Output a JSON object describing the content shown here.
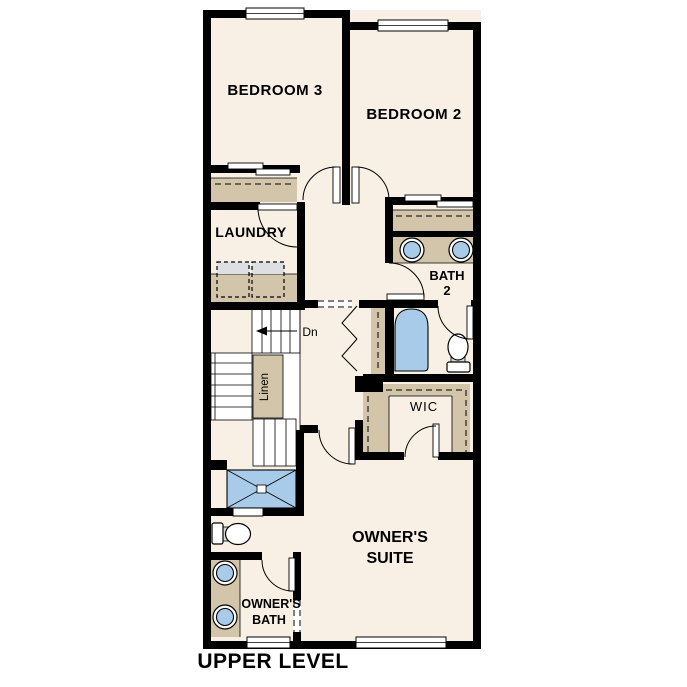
{
  "title": "UPPER LEVEL",
  "palette": {
    "wall": "#000000",
    "floor": "#F8F0E4",
    "casework": "#D3C5A9",
    "fixture": "#A9CBEA",
    "appliance": "#DCE0E3",
    "background": "#FFFFFF",
    "text": "#000000"
  },
  "rooms": {
    "bedroom3": {
      "label": "BEDROOM 3"
    },
    "bedroom2": {
      "label": "BEDROOM 2"
    },
    "laundry": {
      "label": "LAUNDRY"
    },
    "bath2": {
      "label1": "BATH",
      "label2": "2"
    },
    "wic": {
      "label": "WIC"
    },
    "owners_suite": {
      "label1": "OWNER'S",
      "label2": "SUITE"
    },
    "owners_bath": {
      "label1": "OWNER'S",
      "label2": "BATH"
    },
    "linen": {
      "label": "Linen"
    },
    "stairs": {
      "down_label": "Dn"
    }
  }
}
